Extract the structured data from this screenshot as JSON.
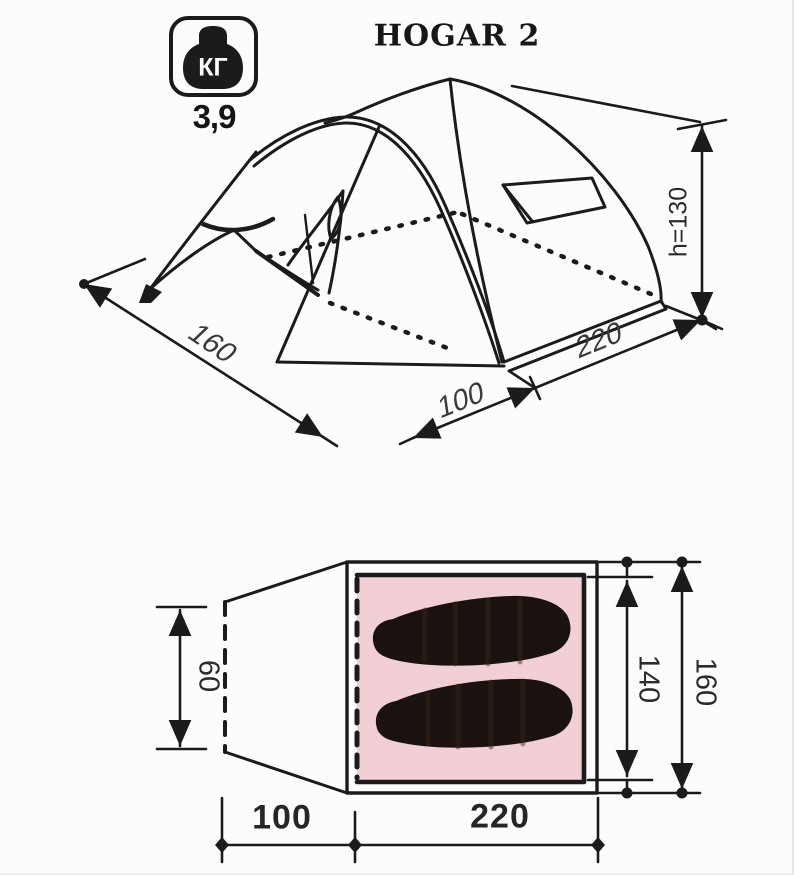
{
  "title": "HOGAR 2",
  "weight_badge": {
    "unit": "КГ",
    "value": "3,9"
  },
  "perspective_view": {
    "dims": {
      "ground_width": "160",
      "vestibule_depth": "100",
      "side_length": "220",
      "height": "h=130"
    }
  },
  "floor_plan": {
    "dims": {
      "vestibule_depth": "60",
      "inner_width": "140",
      "outer_width": "160",
      "vestibule_length": "100",
      "inner_length": "220"
    }
  },
  "colors": {
    "line": "#1b1b1b",
    "floor_fill": "#f2cfd5",
    "mat_fill": "#1a120e",
    "background": "#fcfcfc"
  }
}
